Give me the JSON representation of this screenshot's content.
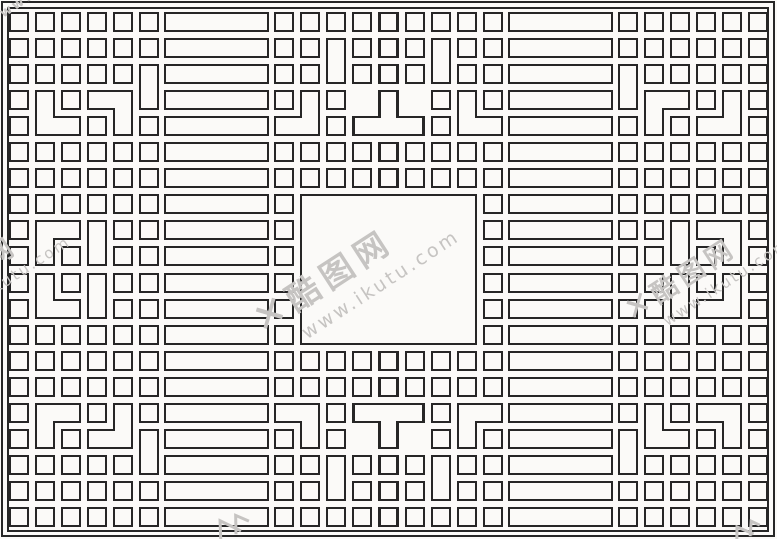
{
  "canvas": {
    "width": 777,
    "height": 539,
    "background": "#fbfaf8",
    "line_color": "#262626",
    "line_width": 2
  },
  "pattern": {
    "description": "chinese-lattice-grille",
    "symmetry": "4-way-mirror",
    "grid": {
      "origin_x": 10,
      "origin_y": 13,
      "pitch": 26,
      "square": 18
    },
    "static_rects": [
      [
        2,
        2,
        772,
        534
      ],
      [
        8,
        8,
        760,
        523
      ],
      [
        301,
        195,
        175,
        149
      ]
    ],
    "shapes": [
      [
        "sq",
        10,
        13
      ],
      [
        "sq",
        36,
        13
      ],
      [
        "sq",
        62,
        13
      ],
      [
        "sq",
        88,
        13
      ],
      [
        "sq",
        114,
        13
      ],
      [
        "sq",
        140,
        13
      ],
      [
        "sq",
        10,
        39
      ],
      [
        "sq",
        36,
        39
      ],
      [
        "sq",
        62,
        39
      ],
      [
        "sq",
        88,
        39
      ],
      [
        "sq",
        114,
        39
      ],
      [
        "sq",
        140,
        39
      ],
      [
        "sq",
        10,
        65
      ],
      [
        "sq",
        36,
        65
      ],
      [
        "sq",
        62,
        65
      ],
      [
        "sq",
        88,
        65
      ],
      [
        "sq",
        114,
        65
      ],
      [
        "vd",
        140,
        65
      ],
      [
        "sq",
        10,
        91
      ],
      [
        "sbr",
        36,
        91
      ],
      [
        "sq",
        62,
        91
      ],
      [
        "lbr",
        88,
        91
      ],
      [
        "sq",
        10,
        117
      ],
      [
        "sq",
        88,
        117
      ],
      [
        "sq",
        140,
        117
      ],
      [
        "sq",
        10,
        143
      ],
      [
        "sq",
        36,
        143
      ],
      [
        "sq",
        62,
        143
      ],
      [
        "sq",
        88,
        143
      ],
      [
        "sq",
        114,
        143
      ],
      [
        "sq",
        140,
        143
      ],
      [
        "sq",
        10,
        169
      ],
      [
        "sq",
        36,
        169
      ],
      [
        "sq",
        62,
        169
      ],
      [
        "sq",
        88,
        169
      ],
      [
        "sq",
        114,
        169
      ],
      [
        "sq",
        140,
        169
      ],
      [
        "sq",
        10,
        195
      ],
      [
        "sq",
        36,
        195
      ],
      [
        "sq",
        62,
        195
      ],
      [
        "sq",
        88,
        195
      ],
      [
        "sq",
        114,
        195
      ],
      [
        "sq",
        140,
        195
      ],
      [
        "sq",
        10,
        221
      ],
      [
        "str",
        36,
        221
      ],
      [
        "vd",
        88,
        221
      ],
      [
        "sq",
        114,
        221
      ],
      [
        "sq",
        140,
        221
      ],
      [
        "sq",
        10,
        247
      ],
      [
        "sq",
        62,
        247
      ],
      [
        "sq",
        114,
        247
      ],
      [
        "sq",
        140,
        247
      ],
      [
        "bar",
        165,
        13
      ],
      [
        "bar",
        165,
        39
      ],
      [
        "bar",
        165,
        65
      ],
      [
        "bar",
        165,
        91
      ],
      [
        "bar",
        165,
        117
      ],
      [
        "bar",
        165,
        143
      ],
      [
        "bar",
        165,
        169
      ],
      [
        "bar",
        165,
        195
      ],
      [
        "bar",
        165,
        221
      ],
      [
        "bar",
        165,
        247
      ],
      [
        "sq",
        275,
        13
      ],
      [
        "sq",
        301,
        13
      ],
      [
        "sq",
        327,
        13
      ],
      [
        "sq",
        353,
        13
      ],
      [
        "sq",
        379,
        13
      ],
      [
        "sq",
        275,
        39
      ],
      [
        "sq",
        301,
        39
      ],
      [
        "vd",
        327,
        39
      ],
      [
        "sq",
        353,
        39
      ],
      [
        "sq",
        379,
        39
      ],
      [
        "sq",
        275,
        65
      ],
      [
        "sq",
        301,
        65
      ],
      [
        "sq",
        353,
        65
      ],
      [
        "sq",
        379,
        65
      ],
      [
        "sq",
        275,
        91
      ],
      [
        "sbl",
        275,
        91
      ],
      [
        "sq",
        327,
        91
      ],
      [
        "teeup",
        353,
        91
      ],
      [
        "sq",
        327,
        117
      ],
      [
        "sq",
        275,
        143
      ],
      [
        "sq",
        301,
        143
      ],
      [
        "sq",
        327,
        143
      ],
      [
        "sq",
        353,
        143
      ],
      [
        "sq",
        379,
        143
      ],
      [
        "sq",
        275,
        169
      ],
      [
        "sq",
        301,
        169
      ],
      [
        "sq",
        327,
        169
      ],
      [
        "sq",
        353,
        169
      ],
      [
        "sq",
        379,
        169
      ],
      [
        "sq",
        275,
        195
      ],
      [
        "sq",
        275,
        221
      ],
      [
        "sq",
        275,
        247
      ]
    ]
  },
  "watermark": {
    "x_mark": "✕",
    "site_name": "酷图网",
    "url": "www.ikutu.com",
    "corner_fragment": "www",
    "color": "#c6c4c2",
    "angle_deg": -33,
    "instances": [
      {
        "id": "center",
        "x": 389,
        "y": 268,
        "scale": 1.0
      },
      {
        "id": "left",
        "x": 14,
        "y": 270,
        "scale": 0.8
      },
      {
        "id": "right",
        "x": 733,
        "y": 272,
        "scale": 0.8
      }
    ]
  }
}
